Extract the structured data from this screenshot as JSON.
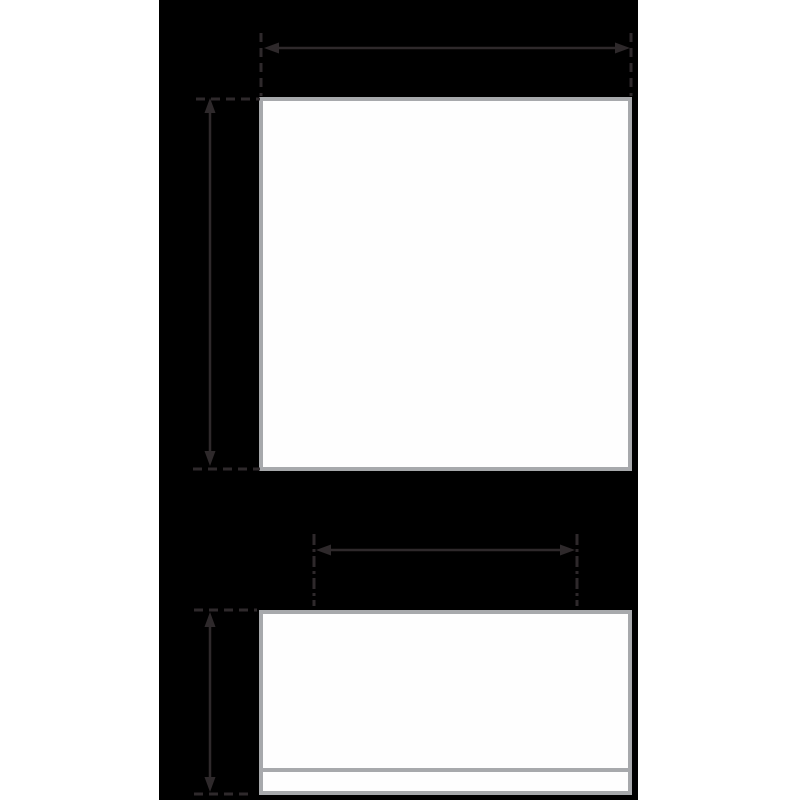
{
  "colors": {
    "page_background": "#ffffff",
    "canvas_background": "#000000",
    "panel_fill": "#fefefe",
    "panel_border": "#a7a9ac",
    "base_divider": "#a7a9ac",
    "dimension_stroke": "#2e292b"
  },
  "diagram": {
    "type": "dimension-diagram",
    "panels": [
      {
        "name": "artwork-panel",
        "shape": "rectangle",
        "fill": "white",
        "border": "light-gray"
      },
      {
        "name": "base-panel",
        "shape": "rectangle",
        "fill": "white",
        "border": "light-gray",
        "has_bottom_strip": true
      }
    ],
    "dimension_annotations": [
      {
        "name": "artwork-width",
        "orientation": "horizontal",
        "arrowheads": "both-ends",
        "extension_style": "dashed"
      },
      {
        "name": "artwork-height",
        "orientation": "vertical",
        "arrowheads": "both-ends",
        "extension_style": "dashed"
      },
      {
        "name": "base-inner-width",
        "orientation": "horizontal",
        "arrowheads": "both-ends",
        "extension_style": "dash-dot"
      },
      {
        "name": "base-height",
        "orientation": "vertical",
        "arrowheads": "both-ends",
        "extension_style": "dashed"
      }
    ]
  }
}
